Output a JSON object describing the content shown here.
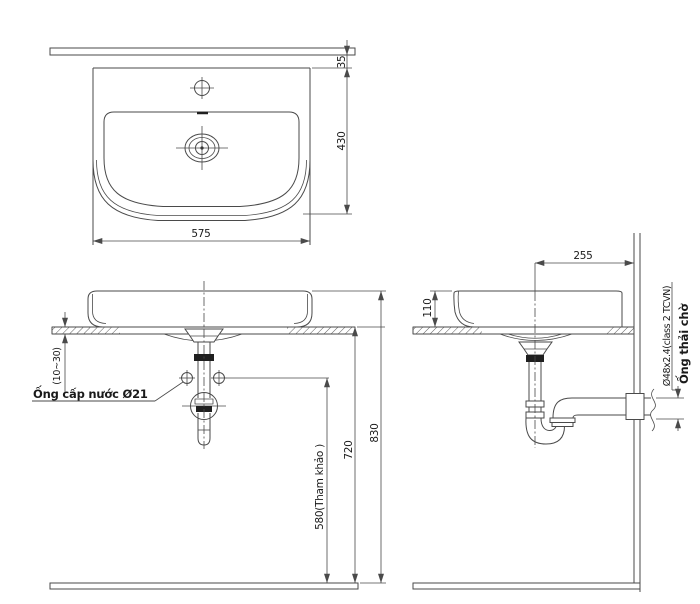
{
  "colors": {
    "line": "#4a4a4a",
    "text": "#1a1a1a",
    "background": "#ffffff",
    "fitting_fill": "#1f1f1f"
  },
  "drawing": {
    "plan_view": {
      "dim_wall_gap": "35",
      "dim_depth": "430",
      "dim_width": "575"
    },
    "front_view": {
      "dim_counter_thickness": "(10~30)",
      "label_supply_pipe": "Ống cấp nước Ø21",
      "dim_supply_height": "580(Tham khảo )",
      "dim_counter_height": "720",
      "dim_total_height": "830"
    },
    "side_view": {
      "dim_drain_to_wall": "255",
      "dim_basin_height": "110",
      "label_waste_spec": "Ø48x2.4(class 2 TCVN)",
      "label_waste_outlet": "Ống thải chờ"
    }
  }
}
